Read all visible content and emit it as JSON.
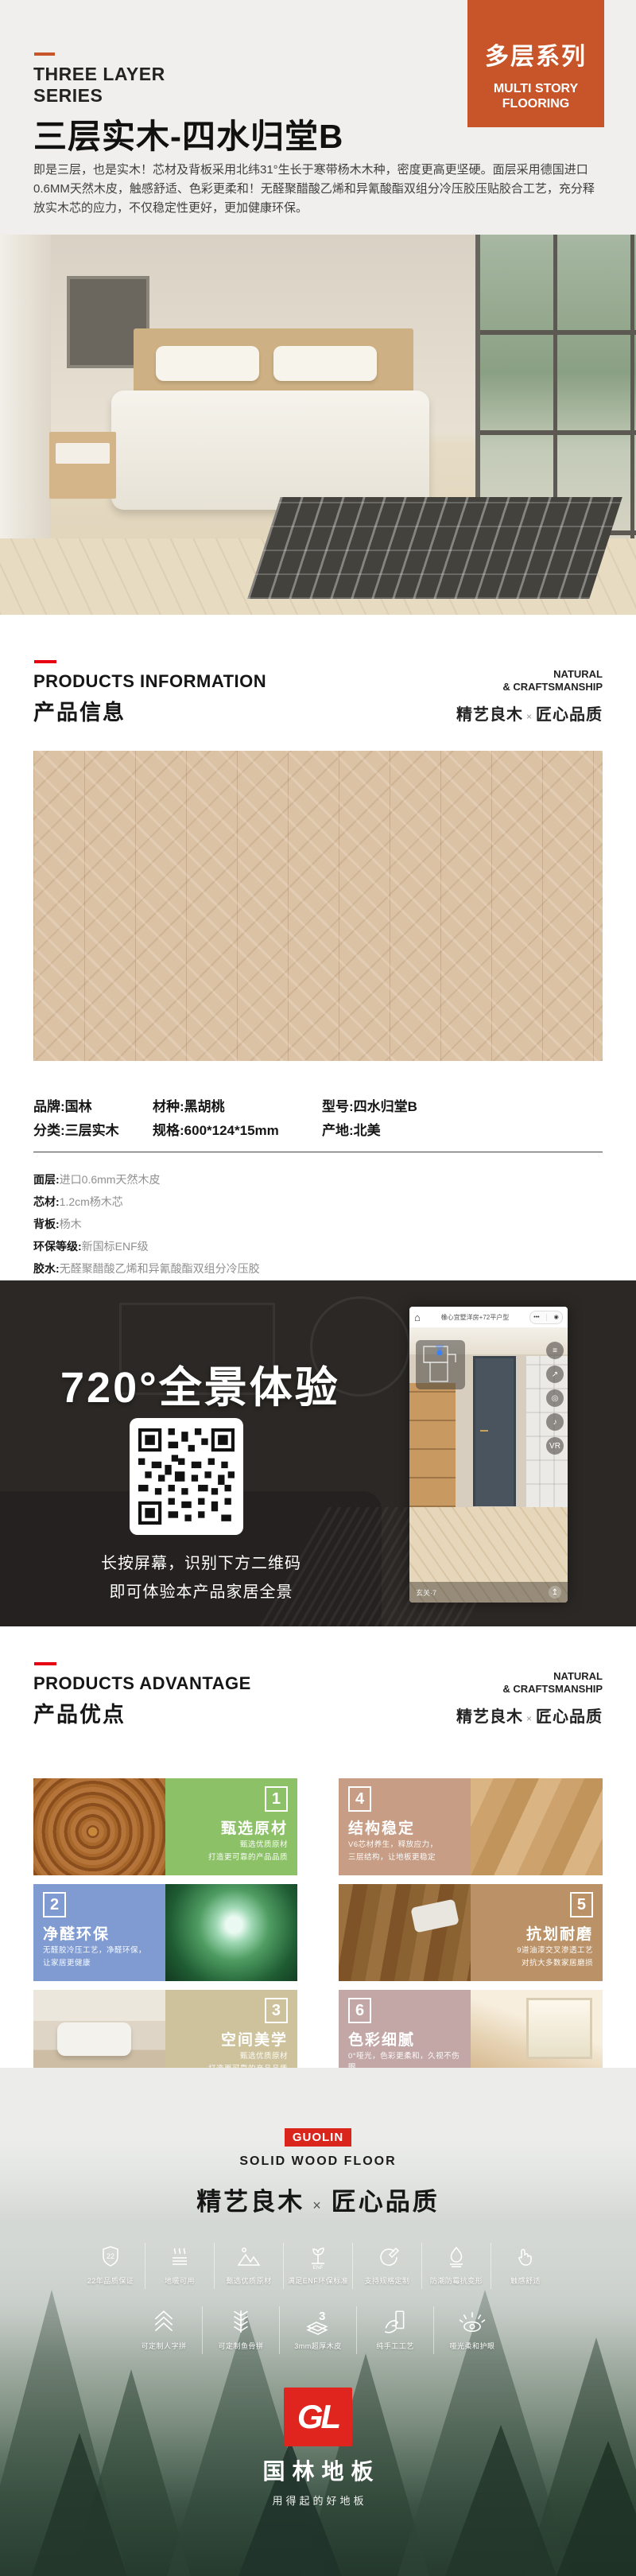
{
  "header": {
    "series_en_line1": "THREE LAYER",
    "series_en_line2": "SERIES",
    "title": "三层实木-四水归堂B",
    "description": "即是三层，也是实木！芯材及背板采用北纬31°生长于寒带杨木木种，密度更高更坚硬。面层采用德国进口0.6MM天然木皮，触感舒适、色彩更柔和！无醛聚醋酸乙烯和异氰酸酯双组分冷压胶压贴胶合工艺，充分释放实木芯的应力，不仅稳定性更好，更加健康环保。",
    "badge": {
      "cn": "多层系列",
      "en_line1": "MULTI STORY",
      "en_line2": "FLOORING",
      "color": "#c8552a"
    }
  },
  "section_info": {
    "en": "PRODUCTS INFORMATION",
    "cn": "产品信息"
  },
  "section_adv": {
    "en": "PRODUCTS ADVANTAGE",
    "cn": "产品优点"
  },
  "section_right": {
    "en_line1": "NATURAL",
    "en_line2": "& CRAFTSMANSHIP",
    "cn_left": "精艺良木",
    "times": "×",
    "cn_right": "匠心品质"
  },
  "specs": {
    "grid": [
      [
        {
          "label": "品牌:",
          "value": "国林"
        },
        {
          "label": "材种:",
          "value": "黑胡桃"
        },
        {
          "label": "型号:",
          "value": "四水归堂B"
        }
      ],
      [
        {
          "label": "分类:",
          "value": "三层实木"
        },
        {
          "label": "规格:",
          "value": "600*124*15mm"
        },
        {
          "label": "产地:",
          "value": "北美"
        }
      ]
    ],
    "details": [
      {
        "label": "面层:",
        "value": "进口0.6mm天然木皮"
      },
      {
        "label": "芯材:",
        "value": "1.2cm杨木芯"
      },
      {
        "label": "背板:",
        "value": "杨木"
      },
      {
        "label": "环保等级:",
        "value": "新国标ENF级"
      },
      {
        "label": "胶水:",
        "value": "无醛聚醋酸乙烯和异氰酸酯双组分冷压胶"
      }
    ]
  },
  "panorama": {
    "title": "720°全景体验",
    "tip_line1": "长按屏幕，识别下方二维码",
    "tip_line2": "即可体验本产品家居全景",
    "phone": {
      "home": "⌂",
      "title": "橡心宜墅洋房+72平户型",
      "capsule_dots": "•••",
      "capsule_circle": "◉",
      "buttons": [
        "≡",
        "↗",
        "◎",
        "♪",
        "VR"
      ],
      "bottom_label": "玄关·7",
      "upload": "↥"
    }
  },
  "advantages": [
    {
      "num": "1",
      "title": "甄选原材",
      "lines": [
        "甄选优质原材",
        "打造更可靠的产品品质"
      ],
      "color": "#8dc168"
    },
    {
      "num": "4",
      "title": "结构稳定",
      "lines": [
        "V6芯材养生，释放应力，",
        "三层结构，让地板更稳定"
      ],
      "color": "#c79d85"
    },
    {
      "num": "2",
      "title": "净醛环保",
      "lines": [
        "无醛胶冷压工艺，净醛环保，",
        "让家居更健康"
      ],
      "color": "#7f9bd2"
    },
    {
      "num": "5",
      "title": "抗划耐磨",
      "lines": [
        "9道油漆交叉渗透工艺",
        "对抗大多数家居磨损"
      ],
      "color": "#bb9267"
    },
    {
      "num": "3",
      "title": "空间美学",
      "lines": [
        "甄选优质原材",
        "打造更可靠的产品品质"
      ],
      "color": "#cdc29b"
    },
    {
      "num": "6",
      "title": "色彩细腻",
      "lines": [
        "0°哑光，色彩更柔和，久视不伤眼",
        ""
      ],
      "color": "#c3a7a6"
    }
  ],
  "footer": {
    "badge": "GUOLIN",
    "sub": "SOLID WOOD FLOOR",
    "features_row1": [
      {
        "icon": "shield-22-icon",
        "label": "22年品质保证",
        "glyph": "22"
      },
      {
        "icon": "floor-heating-icon",
        "label": "地暖可用"
      },
      {
        "icon": "mountains-icon",
        "label": "甄选优质原材"
      },
      {
        "icon": "enf-sprout-icon",
        "label": "满足ENF环保标准",
        "glyph": "ENF"
      },
      {
        "icon": "custom-spec-icon",
        "label": "支持规格定制"
      },
      {
        "icon": "water-drop-icon",
        "label": "防潮防霉抗变形"
      },
      {
        "icon": "hand-touch-icon",
        "label": "触感舒适"
      }
    ],
    "features_row2": [
      {
        "icon": "herringbone-icon",
        "label": "可定制人字拼"
      },
      {
        "icon": "fishbone-icon",
        "label": "可定制鱼骨拼"
      },
      {
        "icon": "veneer-3mm-icon",
        "label": "3mm超厚木皮",
        "glyph": "3"
      },
      {
        "icon": "handcraft-icon",
        "label": "纯手工工艺"
      },
      {
        "icon": "eye-protect-icon",
        "label": "哑光柔和护眼"
      }
    ],
    "logo": {
      "mark": "GL",
      "name": "国林地板",
      "tagline": "用得起的好地板"
    }
  },
  "colors": {
    "accent_orange": "#c8552a",
    "accent_red": "#e60012",
    "brand_red": "#da251c",
    "dark_section": "#2b2825"
  }
}
